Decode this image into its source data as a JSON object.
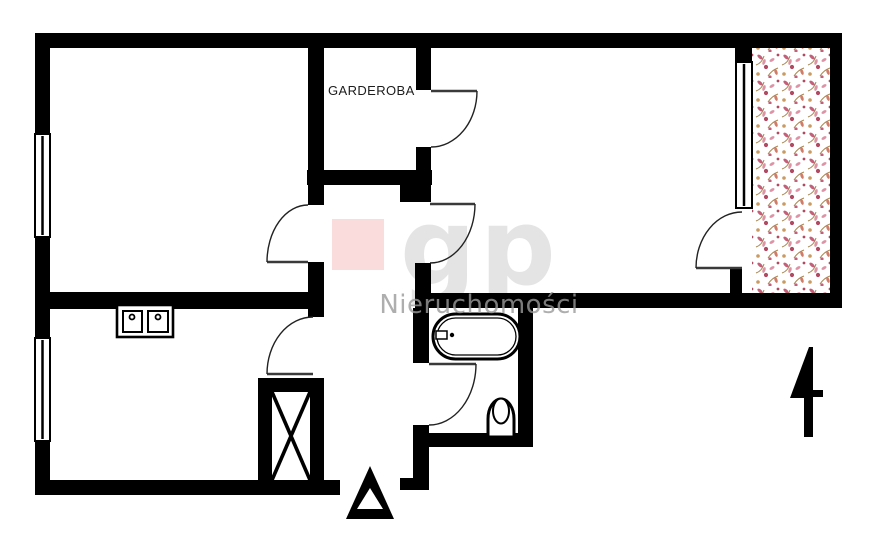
{
  "plan": {
    "room_label": "GARDEROBA",
    "watermark": {
      "logo": "gp",
      "subtitle": "Nieruchomości"
    },
    "colors": {
      "wall": "#000000",
      "background": "#ffffff",
      "watermark_pink": "#fbdcdc",
      "watermark_gray": "#e4e4e4",
      "watermark_subtitle_gray": "#9a9a9a",
      "floral_rose": "#c2607a",
      "floral_light": "#dd93a5",
      "floral_deep": "#b04a62",
      "floral_coral": "#cf7d68",
      "floral_tan": "#c99a62",
      "floral_stem": "#a9854f"
    }
  }
}
